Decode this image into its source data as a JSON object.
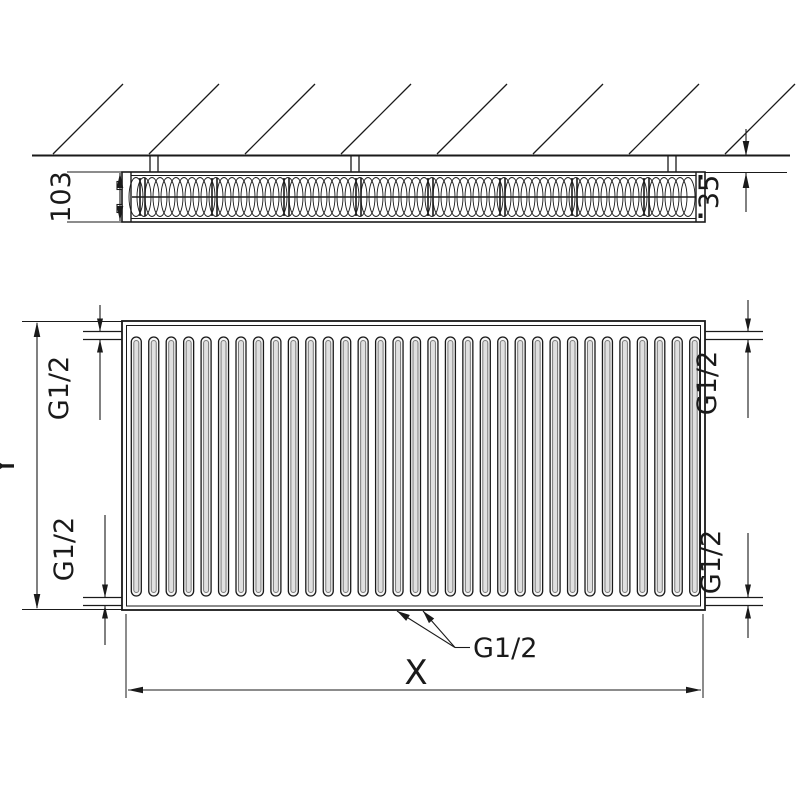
{
  "drawing": {
    "title": "panel radiator dimensional drawing",
    "colors": {
      "line": "#1a1a1a",
      "background": "#ffffff",
      "slot_fill": "#f6f6f6",
      "slot_inner_fill": "#e0e0e0",
      "slot_inner_stroke": "#7a7a7a"
    },
    "top_view": {
      "depth_label": "103",
      "wall_distance_label": "35"
    },
    "front_view": {
      "height_label": "Y",
      "width_label": "X",
      "connections": {
        "top_left": "G1/2",
        "top_right": "G1/2",
        "bottom_left": "G1/2",
        "bottom_right": "G1/2",
        "bottom_center": "G1/2"
      }
    }
  }
}
